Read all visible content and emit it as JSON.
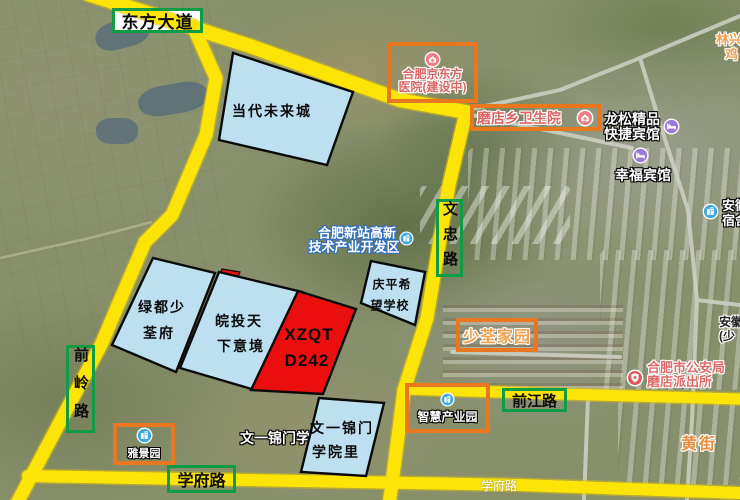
{
  "road_labels": {
    "dongfang_avenue": "东方大道",
    "wenzhong_road": "文忠路",
    "qianling_road": "前岭路",
    "qianjiang_road": "前江路",
    "xuefu_road": "学府路",
    "xuefu_road_map_label": "学府路",
    "huang_street": "黄街"
  },
  "parcels": [
    {
      "name": "dangdai-future-city",
      "lines": [
        "当代未来城",
        ""
      ]
    },
    {
      "name": "lvdu-shaoquanfu",
      "lines": [
        "绿都少",
        "荃府"
      ]
    },
    {
      "name": "wantou-tianxiayijing",
      "lines": [
        "皖投天",
        "下意境"
      ]
    },
    {
      "name": "qingping-hope-school",
      "lines": [
        "庆平希",
        "望学校"
      ]
    },
    {
      "name": "wenyi-jinmen-yuanli",
      "lines": [
        "文一锦门",
        "学院里"
      ]
    },
    {
      "name": "xzqt-d242",
      "lines": [
        "XZQT",
        "D242"
      ]
    }
  ],
  "boxes": {
    "bjd_hospital": {
      "line1": "合肥京东方",
      "line2": "医院(建设中)"
    },
    "modian_clinic": {
      "label": "磨店乡卫生院"
    },
    "shaoquan_home": {
      "label": "少荃家园"
    },
    "smart_park": {
      "label": "智慧产业园"
    },
    "yajing_garden": {
      "label": "雅景园"
    }
  },
  "pois": {
    "longsong_hotel": {
      "line1": "龙松精品",
      "line2": "快捷宾馆"
    },
    "xingfu_hotel": {
      "label": "幸福宾馆"
    },
    "anhui_dorm": {
      "line1": "安徽",
      "line2": "宿舍"
    },
    "anhui_shaoquan": {
      "line1": "安徽",
      "line2": "(少"
    },
    "police_station": {
      "line1": "合肥市公安局",
      "line2": "磨店派出所"
    },
    "xinzhan_zone": {
      "line1": "合肥新站高新",
      "line2": "技术产业开发区"
    },
    "linxing": {
      "line1": "林兴",
      "line2": "鸡"
    },
    "wenyi_map_label": "文一锦门学院"
  },
  "colors": {
    "road_highlight_yellow": "#FCE506",
    "parcel_blue": "#BCE0F0",
    "parcel_red": "#EA0E0E",
    "road_label_border_green": "#0E9C44",
    "poi_box_border_orange": "#E8771F",
    "hospital_text_pink": "#DD6464",
    "orange_label_text": "#F0A050",
    "building_icon_blue": "#3FA9DD",
    "hotel_icon_purple": "#9C7AD4",
    "police_icon_red": "#E05A5A",
    "hospital_icon_pink": "#ED8087"
  }
}
